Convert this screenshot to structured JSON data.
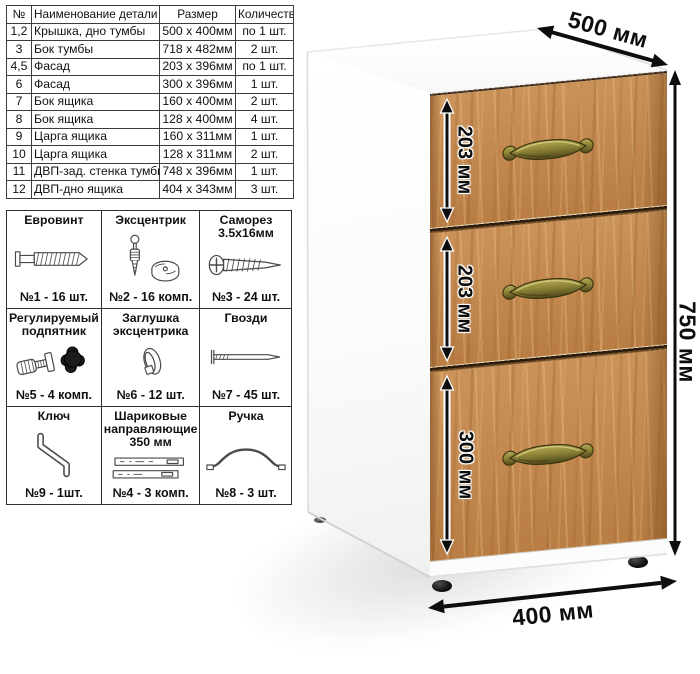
{
  "parts_table": {
    "headers": [
      "№",
      "Наименование детали",
      "Размер",
      "Количество"
    ],
    "rows": [
      {
        "num": "1,2",
        "name": "Крышка, дно тумбы",
        "size": "500 х 400мм",
        "qty": "по 1 шт."
      },
      {
        "num": "3",
        "name": "Бок тумбы",
        "size": "718 х 482мм",
        "qty": "2 шт."
      },
      {
        "num": "4,5",
        "name": "Фасад",
        "size": "203 х 396мм",
        "qty": "по 1 шт."
      },
      {
        "num": "6",
        "name": "Фасад",
        "size": "300 х 396мм",
        "qty": "1 шт."
      },
      {
        "num": "7",
        "name": "Бок ящика",
        "size": "160 х 400мм",
        "qty": "2 шт."
      },
      {
        "num": "8",
        "name": "Бок ящика",
        "size": "128 х 400мм",
        "qty": "4 шт."
      },
      {
        "num": "9",
        "name": "Царга ящика",
        "size": "160 х 311мм",
        "qty": "1 шт."
      },
      {
        "num": "10",
        "name": "Царга ящика",
        "size": "128 х 311мм",
        "qty": "2 шт."
      },
      {
        "num": "11",
        "name": "ДВП-зад. стенка тумбы",
        "size": "748 х 396мм",
        "qty": "1 шт."
      },
      {
        "num": "12",
        "name": "ДВП-дно ящика",
        "size": "404 х 343мм",
        "qty": "3 шт."
      }
    ]
  },
  "hardware_table": {
    "cells": [
      {
        "title": "Евровинт",
        "count": "№1 - 16 шт."
      },
      {
        "title": "Эксцентрик",
        "count": "№2 - 16 комп."
      },
      {
        "title": "Саморез 3.5х16мм",
        "count": "№3 - 24 шт."
      },
      {
        "title": "Регулируемый подпятник",
        "count": "№5 - 4 комп."
      },
      {
        "title": "Заглушка эксцентрика",
        "count": "№6 - 12 шт."
      },
      {
        "title": "Гвозди",
        "count": "№7 - 45 шт."
      },
      {
        "title": "Ключ",
        "count": "№9 - 1шт."
      },
      {
        "title": "Шариковые направляющие 350 мм",
        "count": "№4 - 3 комп."
      },
      {
        "title": "Ручка",
        "count": "№8 - 3 шт."
      }
    ]
  },
  "cabinet": {
    "labels": {
      "depth": "500 мм",
      "height": "750 мм",
      "width": "400 мм",
      "drawer_top": "203 мм",
      "drawer_middle": "203 мм",
      "drawer_bottom": "300 мм"
    },
    "colors": {
      "wood_base": "#c2854a",
      "handle_brass": "#8d8437",
      "body_white": "#ffffff",
      "dimension_text": "#0d0d0d"
    }
  }
}
